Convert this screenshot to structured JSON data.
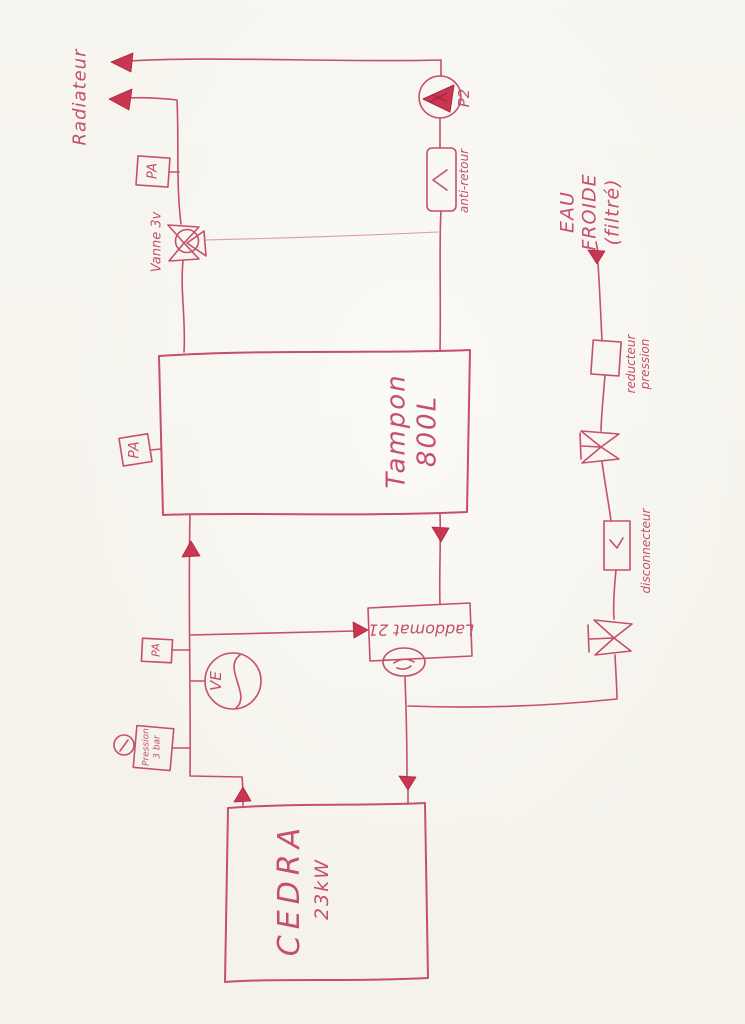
{
  "drawing": {
    "description": "hand-drawn heating schematic, red ink on paper",
    "colors": {
      "ink": "#c5506b",
      "ink_faint": "#dd9aab",
      "arrow_fill": "#c73750",
      "paper": "#f6f4ee"
    }
  },
  "labels": {
    "radiator": "Radiateur",
    "pump": "P2",
    "check_valve": "anti-retour",
    "three_way_valve": "Vanne 3v",
    "air_vent": "PA",
    "tank_name": "Tampon",
    "tank_capacity": "800L",
    "expansion_vessel": "VE",
    "gauge_word": "Pression",
    "gauge_value": "3 bar",
    "loading_unit": "Laddomat 21",
    "boiler_name": "CEDRA",
    "boiler_power": "23kW",
    "cold_water_1": "EAU",
    "cold_water_2": "FROIDE",
    "cold_water_3": "(filtré)",
    "reducer_1": "reducteur",
    "reducer_2": "pression",
    "backflow_preventer": "disconnecteur"
  }
}
